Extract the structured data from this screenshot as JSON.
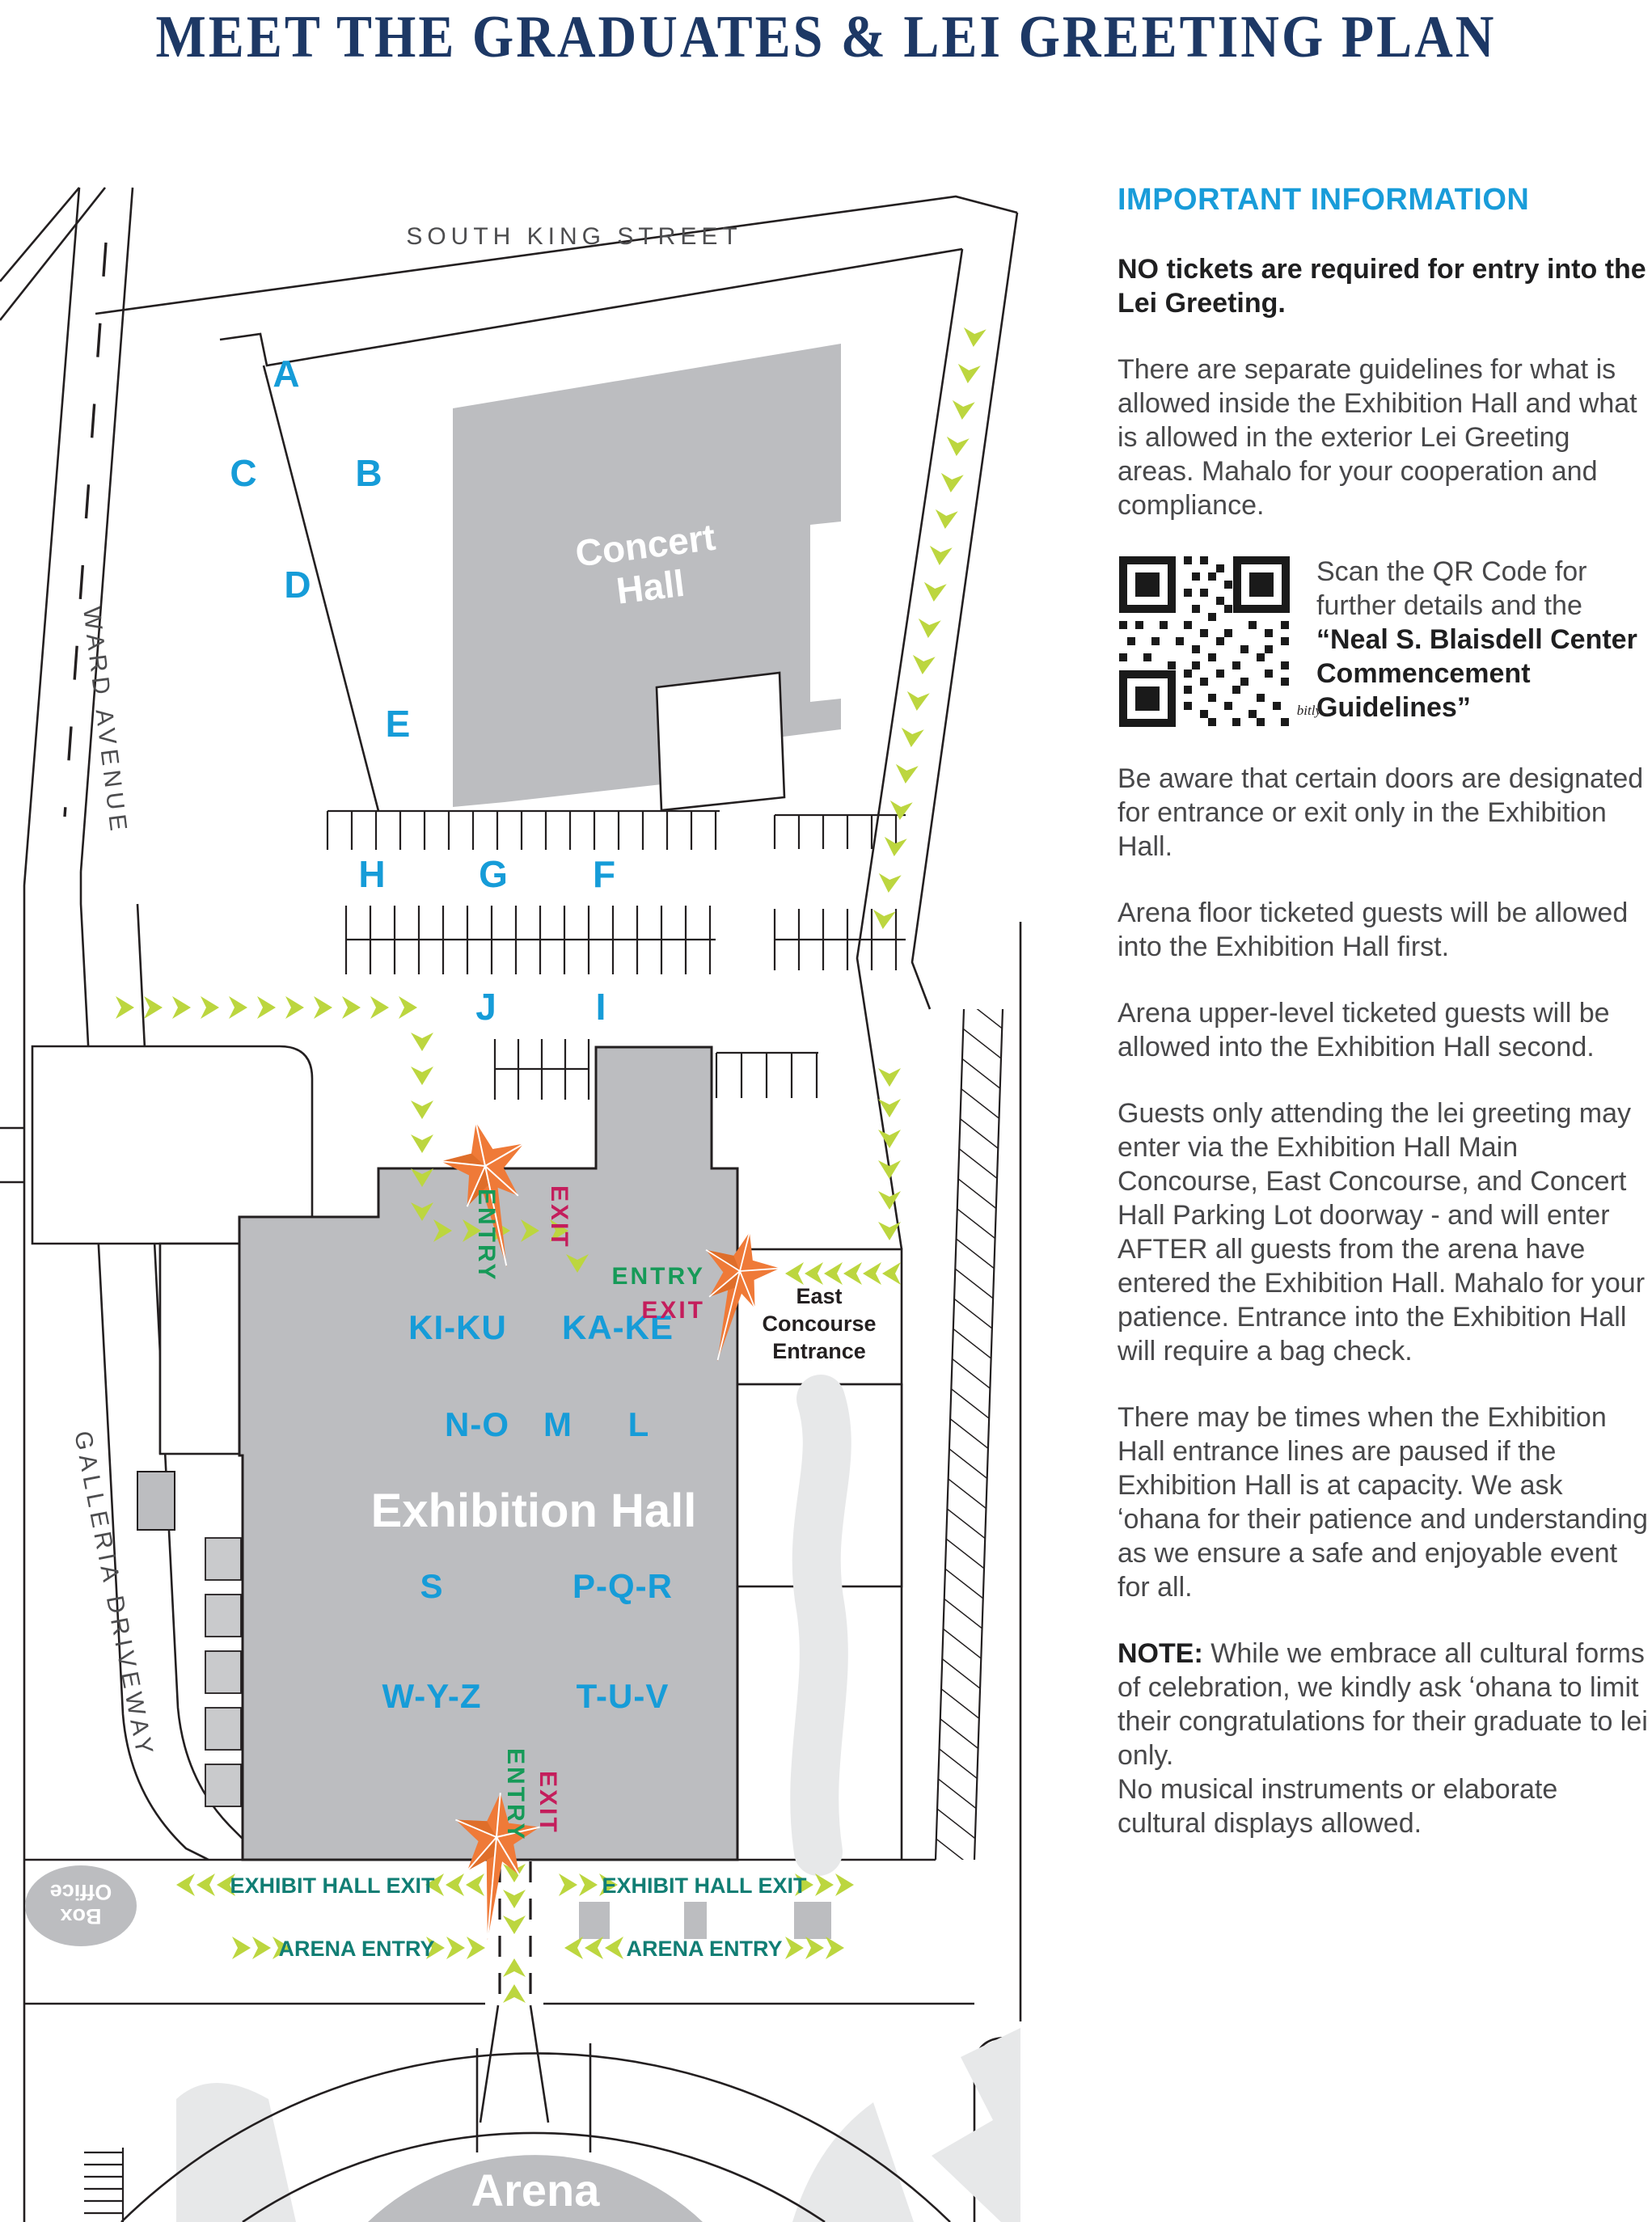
{
  "page": {
    "title": "MEET THE GRADUATES & LEI GREETING PLAN"
  },
  "colors": {
    "accent_blue": "#169cd8",
    "title_navy": "#1d3865",
    "flow_teal": "#117e74",
    "entry_green": "#169a58",
    "exit_magenta": "#c41e5c",
    "chevron_green": "#bcd63f",
    "building_gray": "#bcbdc0",
    "walkway_gray": "#e7e8e9",
    "road_black": "#231f20"
  },
  "map": {
    "streets": {
      "south_king": "SOUTH KING STREET",
      "ward": "WARD AVENUE",
      "galleria": "GALLERIA DRIVEWAY"
    },
    "buildings": {
      "concert_hall": [
        "Concert",
        "Hall"
      ],
      "exhibition_hall": "Exhibition Hall",
      "arena": "Arena",
      "box_office": [
        "Box",
        "Office"
      ]
    },
    "parking_zones": [
      {
        "label": "A"
      },
      {
        "label": "C"
      },
      {
        "label": "B"
      },
      {
        "label": "D"
      },
      {
        "label": "E"
      },
      {
        "label": "H"
      },
      {
        "label": "G"
      },
      {
        "label": "F"
      },
      {
        "label": "J"
      },
      {
        "label": "I"
      }
    ],
    "hall_sections": [
      {
        "label": "KI-KU"
      },
      {
        "label": "KA-KE"
      },
      {
        "label": "N-O"
      },
      {
        "label": "M"
      },
      {
        "label": "L"
      },
      {
        "label": "S"
      },
      {
        "label": "P-Q-R"
      },
      {
        "label": "W-Y-Z"
      },
      {
        "label": "T-U-V"
      }
    ],
    "gates": {
      "entry": "ENTRY",
      "exit": "EXIT"
    },
    "east_concourse": [
      "East",
      "Concourse",
      "Entrance"
    ],
    "flow_labels": {
      "exhibit_hall_exit": "EXHIBIT HALL EXIT",
      "arena_entry": "ARENA ENTRY"
    }
  },
  "info": {
    "heading": "IMPORTANT INFORMATION",
    "p1": "NO tickets are required for entry into the Lei Greeting.",
    "p2": "There are separate guidelines for what is allowed inside the Exhibition Hall and what is allowed in the exterior Lei Greeting areas. Mahalo for your cooperation and compliance.",
    "qr_plain": "Scan the QR Code for further details and the ",
    "qr_bold": "“Neal S. Blaisdell Center Commencement Guidelines”",
    "p3": "Be aware that certain doors are designated for entrance or exit only in the Exhibition Hall.",
    "p4": "Arena floor ticketed guests will be allowed into the Exhibition Hall first.",
    "p5": "Arena upper-level ticketed guests will be allowed into the Exhibition Hall second.",
    "p6": "Guests only attending the lei greeting may enter via the Exhibition Hall Main Concourse, East Concourse, and Concert Hall Parking Lot doorway - and will enter AFTER all guests from the arena have entered the Exhibition Hall. Mahalo for your patience. Entrance into the Exhibition Hall will require a bag check.",
    "p7": "There may be times when the Exhibition Hall entrance lines are paused if the Exhibition Hall is at capacity. We ask ʻohana for their patience and understanding as we ensure a safe and enjoyable event for all.",
    "note_label": "NOTE:",
    "note_a": " While we embrace all cultural forms of celebration, we kindly ask ʻohana to limit their congratulations for their graduate to lei only.",
    "note_b": "No musical instruments or elaborate cultural displays allowed."
  },
  "qr": {
    "caption": "bitly"
  }
}
